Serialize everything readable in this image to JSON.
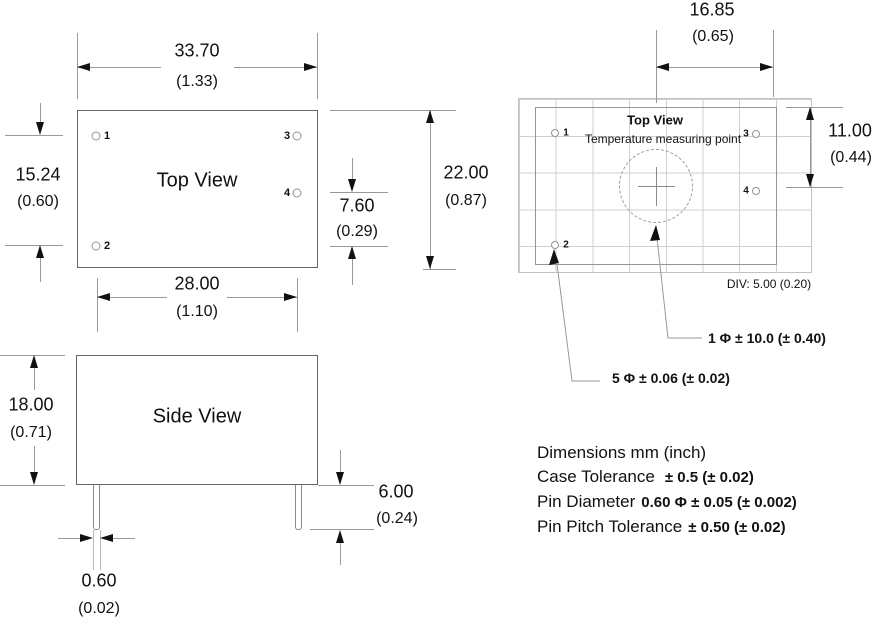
{
  "colors": {
    "ink": "#111111",
    "outline": "#666666",
    "dim_line": "#999999",
    "grid_line": "#cfcfcf"
  },
  "top_view": {
    "title": "Top View",
    "pins": [
      "1",
      "2",
      "3",
      "4"
    ],
    "width_mm": "33.70",
    "width_in": "(1.33)",
    "pin_span_mm": "15.24",
    "pin_span_in": "(0.60)",
    "pin4_offset_mm": "7.60",
    "pin4_offset_in": "(0.29)",
    "height_mm": "22.00",
    "height_in": "(0.87)",
    "pitch_mm": "28.00",
    "pitch_in": "(1.10)"
  },
  "side_view": {
    "title": "Side View",
    "height_mm": "18.00",
    "height_in": "(0.71)",
    "pin_length_mm": "6.00",
    "pin_length_in": "(0.24)",
    "pin_dia_mm": "0.60",
    "pin_dia_in": "(0.02)"
  },
  "grid_view": {
    "title": "Top View",
    "subtitle": "Temperature measuring point",
    "pins": [
      "1",
      "2",
      "3",
      "4"
    ],
    "offset_mm": "16.85",
    "offset_in": "(0.65)",
    "vspan_mm": "11.00",
    "vspan_in": "(0.44)",
    "div_label": "DIV: 5.00 (0.20)",
    "callout_measuring_point": "1 Φ ± 10.0 (± 0.40)",
    "callout_pin": "5 Φ ± 0.06 (± 0.02)"
  },
  "notes": {
    "units": "Dimensions mm (inch)",
    "case_tolerance_label": "Case Tolerance",
    "case_tolerance_value": "± 0.5 (± 0.02)",
    "pin_diameter_label": "Pin Diameter",
    "pin_diameter_value": "0.60 Φ ± 0.05 (± 0.002)",
    "pin_pitch_label": "Pin Pitch Tolerance",
    "pin_pitch_value": "± 0.50 (± 0.02)"
  }
}
